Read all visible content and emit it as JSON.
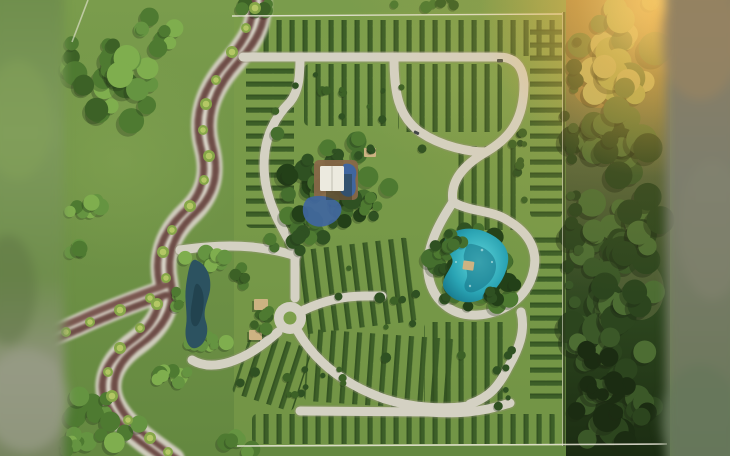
{
  "meta": {
    "title": "Aerial 3D master-plan render: residential lot subdivision with winding boulevard, gravel loop roads, central pavilion with pools, turquoise lagoon, pond and bordering forest",
    "visible_text": "none"
  },
  "palette": {
    "lawnTop": "#7a9c4c",
    "lawnBottom": "#648840",
    "lawnLight": "#86a654",
    "lawnDev": "#7d9f4b",
    "hedge": "#3a5c26",
    "hedgeDark": "#2a471b",
    "tree1": "#4e7a31",
    "tree2": "#659441",
    "tree3": "#7fae4e",
    "tree4": "#3c6126",
    "treeDark1": "#2f5122",
    "treeDark2": "#234018",
    "treeDark3": "#456f2e",
    "palmLight": "#b4c765",
    "palmDark": "#86a748",
    "forest1": "#2c451e",
    "forest2": "#3b5828",
    "forest3": "#4d6d33",
    "forestDark": "#1b2c12",
    "forestSun1": "#9aa851",
    "forestSun2": "#b4b466",
    "forestGround": "#5f6b40",
    "sunGround": "#9c7c40",
    "glow": "#f2b24a",
    "glowHot": "#ffd87d",
    "roadWhite": "#d4d1c3",
    "roadEdge": "#97957c",
    "blvdBed": "#cfccbd",
    "trackBrown": "#7a5750",
    "trackDark": "#61443e",
    "median": "#dfdccf",
    "waterPond": "#2c5260",
    "waterPondDark": "#1e3d49",
    "lagoon1": "#62d8dc",
    "lagoon2": "#2aa4b4",
    "lagoon3": "#157387",
    "poolBlue": "#40669f",
    "deckBrown": "#8a684a",
    "roofWhite": "#eceadf",
    "roofBeige": "#cdb382",
    "shadow": "#1d2a14",
    "boundary": "#ece9dc",
    "blurLTop": "#6f8e4c",
    "blurLMid": "#7e9a5c",
    "blurLGray": "#8f937c",
    "blurLBot": "#74825c",
    "blurRTop": "#8c7e62",
    "blurRMid": "#7d7e6d",
    "blurRGreen": "#70795f",
    "blurRBot": "#68775a"
  },
  "scene": {
    "hedge_blocks": [
      {
        "x": 242,
        "y": 20,
        "w": 318,
        "h": 36,
        "dir": "v"
      },
      {
        "x": 246,
        "y": 64,
        "w": 48,
        "h": 164,
        "dir": "h"
      },
      {
        "x": 304,
        "y": 64,
        "w": 86,
        "h": 62,
        "dir": "v"
      },
      {
        "x": 398,
        "y": 64,
        "w": 104,
        "h": 68,
        "dir": "v"
      },
      {
        "x": 530,
        "y": 22,
        "w": 32,
        "h": 196,
        "dir": "h"
      },
      {
        "x": 530,
        "y": 236,
        "w": 32,
        "h": 168,
        "dir": "h"
      },
      {
        "x": 458,
        "y": 146,
        "w": 64,
        "h": 84,
        "dir": "v"
      },
      {
        "x": 296,
        "y": 244,
        "w": 118,
        "h": 84,
        "dir": "v",
        "rot": -7
      },
      {
        "x": 306,
        "y": 334,
        "w": 148,
        "h": 72,
        "dir": "v",
        "rot": 4
      },
      {
        "x": 424,
        "y": 322,
        "w": 86,
        "h": 84,
        "dir": "v"
      },
      {
        "x": 240,
        "y": 338,
        "w": 64,
        "h": 66,
        "dir": "v",
        "rot": 18
      },
      {
        "x": 252,
        "y": 414,
        "w": 306,
        "h": 30,
        "dir": "v"
      }
    ],
    "clusters": [
      {
        "name": "tl-grove-main",
        "layer": "under",
        "cx": 105,
        "cy": 80,
        "rx": 58,
        "ry": 60,
        "n": 30,
        "rmin": 6,
        "rmax": 14,
        "colors": [
          "tree2",
          "tree3",
          "tree1",
          "tree4"
        ],
        "seed": 7
      },
      {
        "name": "tl-grove-upper",
        "layer": "under",
        "cx": 160,
        "cy": 35,
        "rx": 28,
        "ry": 22,
        "n": 9,
        "rmin": 5,
        "rmax": 10,
        "colors": [
          "tree2",
          "tree3",
          "tree1"
        ],
        "seed": 11
      },
      {
        "name": "tl-grove-small",
        "layer": "under",
        "cx": 88,
        "cy": 205,
        "rx": 24,
        "ry": 16,
        "n": 8,
        "rmin": 5,
        "rmax": 9,
        "colors": [
          "tree2",
          "tree3",
          "tree1"
        ],
        "seed": 13
      },
      {
        "name": "left-single",
        "layer": "under",
        "cx": 76,
        "cy": 253,
        "rx": 13,
        "ry": 9,
        "n": 4,
        "rmin": 4,
        "rmax": 8,
        "colors": [
          "tree2",
          "tree1"
        ],
        "seed": 17
      },
      {
        "name": "topedge-1",
        "layer": "under",
        "cx": 255,
        "cy": 6,
        "rx": 34,
        "ry": 8,
        "n": 7,
        "rmin": 4,
        "rmax": 8,
        "colors": [
          "tree1",
          "tree4"
        ],
        "seed": 19
      },
      {
        "name": "topedge-2",
        "layer": "under",
        "cx": 430,
        "cy": 4,
        "rx": 45,
        "ry": 6,
        "n": 6,
        "rmin": 3,
        "rmax": 6,
        "colors": [
          "tree1",
          "tree4"
        ],
        "seed": 23
      },
      {
        "name": "pond-grove-n",
        "layer": "under",
        "cx": 203,
        "cy": 260,
        "rx": 28,
        "ry": 14,
        "n": 9,
        "rmin": 5,
        "rmax": 9,
        "colors": [
          "tree2",
          "tree3",
          "tree1"
        ],
        "seed": 29
      },
      {
        "name": "pond-grove-s",
        "layer": "under",
        "cx": 206,
        "cy": 347,
        "rx": 28,
        "ry": 12,
        "n": 8,
        "rmin": 4,
        "rmax": 8,
        "colors": [
          "tree2",
          "tree3",
          "tree1"
        ],
        "seed": 31
      },
      {
        "name": "pond-grove-w",
        "layer": "under",
        "cx": 177,
        "cy": 302,
        "rx": 10,
        "ry": 22,
        "n": 6,
        "rmin": 4,
        "rmax": 7,
        "colors": [
          "tree2",
          "tree1"
        ],
        "seed": 37
      },
      {
        "name": "amenity-canopy",
        "layer": "under",
        "cx": 333,
        "cy": 180,
        "rx": 64,
        "ry": 58,
        "n": 52,
        "rmin": 5,
        "rmax": 11,
        "colors": [
          "treeDark1",
          "tree1",
          "treeDark3",
          "treeDark2"
        ],
        "seed": 41
      },
      {
        "name": "amenity-south",
        "layer": "under",
        "cx": 302,
        "cy": 234,
        "rx": 32,
        "ry": 20,
        "n": 14,
        "rmin": 4,
        "rmax": 8,
        "colors": [
          "treeDark1",
          "tree1",
          "treeDark3"
        ],
        "seed": 43
      },
      {
        "name": "lagoon-canopy",
        "layer": "under",
        "cx": 473,
        "cy": 266,
        "rx": 50,
        "ry": 44,
        "n": 44,
        "rmin": 5,
        "rmax": 10,
        "colors": [
          "treeDark1",
          "treeDark2",
          "tree1",
          "treeDark3"
        ],
        "seed": 47
      },
      {
        "name": "dev-shrubs-n",
        "layer": "under",
        "cx": 350,
        "cy": 93,
        "rx": 105,
        "ry": 28,
        "n": 12,
        "rmin": 2.5,
        "rmax": 5,
        "colors": [
          "tree4",
          "treeDark1"
        ],
        "seed": 53
      },
      {
        "name": "dev-shrubs-mid",
        "layer": "under",
        "cx": 430,
        "cy": 305,
        "rx": 115,
        "ry": 75,
        "n": 16,
        "rmin": 2.5,
        "rmax": 5.5,
        "colors": [
          "tree4",
          "treeDark1"
        ],
        "seed": 59
      },
      {
        "name": "dev-shrubs-s",
        "layer": "under",
        "cx": 310,
        "cy": 385,
        "rx": 85,
        "ry": 38,
        "n": 12,
        "rmin": 2.5,
        "rmax": 5,
        "colors": [
          "tree4",
          "treeDark1"
        ],
        "seed": 61
      },
      {
        "name": "dev-shrubs-e",
        "layer": "under",
        "cx": 520,
        "cy": 150,
        "rx": 12,
        "ry": 70,
        "n": 9,
        "rmin": 2.5,
        "rmax": 5,
        "colors": [
          "tree4",
          "treeDark1"
        ],
        "seed": 67
      },
      {
        "name": "sw-grove",
        "layer": "under",
        "cx": 100,
        "cy": 420,
        "rx": 48,
        "ry": 30,
        "n": 15,
        "rmin": 5,
        "rmax": 11,
        "colors": [
          "tree2",
          "tree3",
          "tree1"
        ],
        "seed": 71
      },
      {
        "name": "sw-grove2",
        "layer": "under",
        "cx": 175,
        "cy": 378,
        "rx": 30,
        "ry": 18,
        "n": 9,
        "rmin": 5,
        "rmax": 9,
        "colors": [
          "tree2",
          "tree3",
          "tree1"
        ],
        "seed": 73
      },
      {
        "name": "s-grove3",
        "layer": "under",
        "cx": 228,
        "cy": 442,
        "rx": 27,
        "ry": 14,
        "n": 7,
        "rmin": 5,
        "rmax": 9,
        "colors": [
          "tree2",
          "tree1"
        ],
        "seed": 79
      },
      {
        "name": "bl-corner",
        "layer": "under",
        "cx": 60,
        "cy": 450,
        "rx": 30,
        "ry": 12,
        "n": 6,
        "rmin": 5,
        "rmax": 9,
        "colors": [
          "tree2",
          "tree1"
        ],
        "seed": 83
      },
      {
        "name": "lagoon-rim-nw",
        "layer": "over",
        "cx": 448,
        "cy": 242,
        "rx": 20,
        "ry": 13,
        "n": 8,
        "rmin": 4,
        "rmax": 7,
        "colors": [
          "treeDark1",
          "treeDark3"
        ],
        "seed": 89
      },
      {
        "name": "lagoon-rim-se",
        "layer": "over",
        "cx": 492,
        "cy": 296,
        "rx": 18,
        "ry": 10,
        "n": 6,
        "rmin": 4,
        "rmax": 7,
        "colors": [
          "treeDark1",
          "treeDark2"
        ],
        "seed": 97
      },
      {
        "name": "amenity-rim",
        "layer": "over",
        "cx": 366,
        "cy": 206,
        "rx": 16,
        "ry": 12,
        "n": 7,
        "rmin": 4,
        "rmax": 7,
        "colors": [
          "treeDark1",
          "tree1"
        ],
        "seed": 101
      },
      {
        "name": "roundabout-trees",
        "layer": "over",
        "cx": 262,
        "cy": 318,
        "rx": 26,
        "ry": 20,
        "n": 8,
        "rmin": 3.5,
        "rmax": 6.5,
        "colors": [
          "tree1",
          "tree4"
        ],
        "seed": 103
      },
      {
        "name": "entrance-trees",
        "layer": "over",
        "cx": 238,
        "cy": 276,
        "rx": 16,
        "ry": 12,
        "n": 6,
        "rmin": 3.5,
        "rmax": 6,
        "colors": [
          "tree1",
          "tree4"
        ],
        "seed": 107
      },
      {
        "name": "road-dots-a",
        "layer": "over",
        "cx": 370,
        "cy": 152,
        "rx": 60,
        "ry": 10,
        "n": 6,
        "rmin": 2.5,
        "rmax": 4.5,
        "colors": [
          "treeDark1"
        ],
        "seed": 109
      },
      {
        "name": "road-dots-b",
        "layer": "over",
        "cx": 505,
        "cy": 370,
        "rx": 18,
        "ry": 40,
        "n": 7,
        "rmin": 2.5,
        "rmax": 4.5,
        "colors": [
          "treeDark1"
        ],
        "seed": 113
      },
      {
        "name": "forest-sunlit",
        "layer": "forest",
        "cx": 618,
        "cy": 50,
        "rx": 48,
        "ry": 52,
        "n": 26,
        "rmin": 8,
        "rmax": 17,
        "colors": [
          "forestSun1",
          "forestSun2",
          "forest3"
        ],
        "seed": 131
      },
      {
        "name": "forest-upper",
        "layer": "forest",
        "cx": 612,
        "cy": 140,
        "rx": 50,
        "ry": 55,
        "n": 26,
        "rmin": 8,
        "rmax": 16,
        "colors": [
          "forest2",
          "forest3",
          "forest1"
        ],
        "seed": 137
      },
      {
        "name": "forest-mid",
        "layer": "forest",
        "cx": 620,
        "cy": 235,
        "rx": 50,
        "ry": 58,
        "n": 28,
        "rmin": 8,
        "rmax": 16,
        "colors": [
          "forest2",
          "forest3",
          "forest1"
        ],
        "seed": 139
      },
      {
        "name": "forest-lower",
        "layer": "forest",
        "cx": 610,
        "cy": 330,
        "rx": 50,
        "ry": 58,
        "n": 28,
        "rmin": 8,
        "rmax": 16,
        "colors": [
          "forest2",
          "forest1",
          "forest3"
        ],
        "seed": 149
      },
      {
        "name": "forest-bottom",
        "layer": "forest",
        "cx": 618,
        "cy": 415,
        "rx": 50,
        "ry": 48,
        "n": 24,
        "rmin": 8,
        "rmax": 15,
        "colors": [
          "forest1",
          "forest2",
          "forestDark"
        ],
        "seed": 151
      },
      {
        "name": "forest-dark-accents",
        "layer": "forest",
        "cx": 600,
        "cy": 380,
        "rx": 40,
        "ry": 60,
        "n": 12,
        "rmin": 5,
        "rmax": 10,
        "colors": [
          "forestDark"
        ],
        "seed": 157
      },
      {
        "name": "forest-edge-spill",
        "layer": "forest",
        "cx": 572,
        "cy": 200,
        "rx": 8,
        "ry": 190,
        "n": 18,
        "rmin": 4,
        "rmax": 8,
        "colors": [
          "forest2",
          "forest1"
        ],
        "seed": 163
      }
    ],
    "palms": [
      {
        "x": 255,
        "y": 8,
        "r": 6
      },
      {
        "x": 246,
        "y": 28,
        "r": 5
      },
      {
        "x": 232,
        "y": 52,
        "r": 6
      },
      {
        "x": 216,
        "y": 80,
        "r": 5
      },
      {
        "x": 206,
        "y": 104,
        "r": 6
      },
      {
        "x": 203,
        "y": 130,
        "r": 5
      },
      {
        "x": 209,
        "y": 156,
        "r": 6
      },
      {
        "x": 204,
        "y": 180,
        "r": 5
      },
      {
        "x": 190,
        "y": 206,
        "r": 6
      },
      {
        "x": 172,
        "y": 230,
        "r": 5
      },
      {
        "x": 163,
        "y": 252,
        "r": 6
      },
      {
        "x": 166,
        "y": 278,
        "r": 5
      },
      {
        "x": 157,
        "y": 304,
        "r": 6
      },
      {
        "x": 140,
        "y": 328,
        "r": 5
      },
      {
        "x": 120,
        "y": 348,
        "r": 6
      },
      {
        "x": 108,
        "y": 372,
        "r": 5
      },
      {
        "x": 112,
        "y": 396,
        "r": 6
      },
      {
        "x": 128,
        "y": 420,
        "r": 5
      },
      {
        "x": 150,
        "y": 438,
        "r": 6
      },
      {
        "x": 168,
        "y": 452,
        "r": 5
      },
      {
        "x": 150,
        "y": 298,
        "r": 5
      },
      {
        "x": 120,
        "y": 310,
        "r": 6
      },
      {
        "x": 90,
        "y": 322,
        "r": 5
      },
      {
        "x": 66,
        "y": 332,
        "r": 5
      }
    ]
  }
}
